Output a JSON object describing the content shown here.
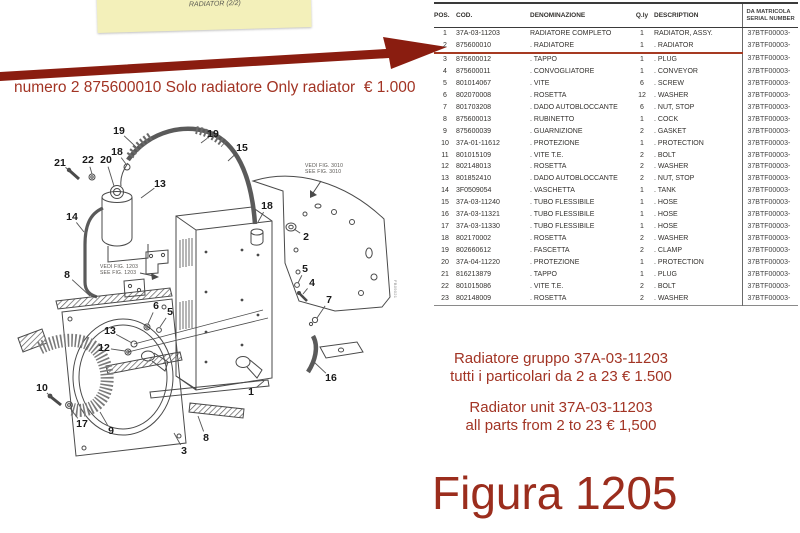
{
  "note": {
    "line1": "FIG. 1205      RADIATORE (2/2)",
    "line2": "RADIATOR (2/2)"
  },
  "annotation_top": "numero 2 875600010 Solo radiatore Only radiator  € 1.000",
  "table": {
    "headers": {
      "pos": "POS.",
      "cod": "COD.",
      "den": "DENOMINAZIONE",
      "qty": "Q.ly",
      "desc": "DESCRIPTION",
      "serial1": "DA MATRICOLA",
      "serial2": "SERIAL NUMBER"
    },
    "highlighted_pos": "2",
    "rows": [
      {
        "pos": "1",
        "cod": "37A-03-11203",
        "den": "RADIATORE COMPLETO",
        "qty": "1",
        "desc": "RADIATOR, ASSY.",
        "serial": "37BTF00003-"
      },
      {
        "pos": "2",
        "cod": "875600010",
        "den": ". RADIATORE",
        "qty": "1",
        "desc": ". RADIATOR",
        "serial": "37BTF00003-"
      },
      {
        "pos": "3",
        "cod": "875600012",
        "den": ". TAPPO",
        "qty": "1",
        "desc": ". PLUG",
        "serial": "37BTF00003-"
      },
      {
        "pos": "4",
        "cod": "875600011",
        "den": ". CONVOGLIATORE",
        "qty": "1",
        "desc": ". CONVEYOR",
        "serial": "37BTF00003-"
      },
      {
        "pos": "5",
        "cod": "801014067",
        "den": ". VITE",
        "qty": "6",
        "desc": ". SCREW",
        "serial": "37BTF00003-"
      },
      {
        "pos": "6",
        "cod": "802070008",
        "den": ". ROSETTA",
        "qty": "12",
        "desc": ". WASHER",
        "serial": "37BTF00003-"
      },
      {
        "pos": "7",
        "cod": "801703208",
        "den": ". DADO AUTOBLOCCANTE",
        "qty": "6",
        "desc": ". NUT, STOP",
        "serial": "37BTF00003-"
      },
      {
        "pos": "8",
        "cod": "875600013",
        "den": ". RUBINETTO",
        "qty": "1",
        "desc": ". COCK",
        "serial": "37BTF00003-"
      },
      {
        "pos": "9",
        "cod": "875600039",
        "den": ". GUARNIZIONE",
        "qty": "2",
        "desc": ". GASKET",
        "serial": "37BTF00003-"
      },
      {
        "pos": "10",
        "cod": "37A-01-11612",
        "den": ". PROTEZIONE",
        "qty": "1",
        "desc": ". PROTECTION",
        "serial": "37BTF00003-"
      },
      {
        "pos": "11",
        "cod": "801015109",
        "den": ". VITE T.E.",
        "qty": "2",
        "desc": ". BOLT",
        "serial": "37BTF00003-"
      },
      {
        "pos": "12",
        "cod": "802148013",
        "den": ". ROSETTA",
        "qty": "2",
        "desc": ". WASHER",
        "serial": "37BTF00003-"
      },
      {
        "pos": "13",
        "cod": "801852410",
        "den": ". DADO AUTOBLOCCANTE",
        "qty": "2",
        "desc": ". NUT, STOP",
        "serial": "37BTF00003-"
      },
      {
        "pos": "14",
        "cod": "3F0509054",
        "den": ". VASCHETTA",
        "qty": "1",
        "desc": ". TANK",
        "serial": "37BTF00003-"
      },
      {
        "pos": "15",
        "cod": "37A-03-11240",
        "den": ". TUBO FLESSIBILE",
        "qty": "1",
        "desc": ". HOSE",
        "serial": "37BTF00003-"
      },
      {
        "pos": "16",
        "cod": "37A-03-11321",
        "den": ". TUBO FLESSIBILE",
        "qty": "1",
        "desc": ". HOSE",
        "serial": "37BTF00003-"
      },
      {
        "pos": "17",
        "cod": "37A-03-11330",
        "den": ". TUBO FLESSIBILE",
        "qty": "1",
        "desc": ". HOSE",
        "serial": "37BTF00003-"
      },
      {
        "pos": "18",
        "cod": "802170002",
        "den": ". ROSETTA",
        "qty": "2",
        "desc": ". WASHER",
        "serial": "37BTF00003-"
      },
      {
        "pos": "19",
        "cod": "802660612",
        "den": ". FASCETTA",
        "qty": "2",
        "desc": ". CLAMP",
        "serial": "37BTF00003-"
      },
      {
        "pos": "20",
        "cod": "37A-04-11220",
        "den": ". PROTEZIONE",
        "qty": "1",
        "desc": ". PROTECTION",
        "serial": "37BTF00003-"
      },
      {
        "pos": "21",
        "cod": "816213879",
        "den": ". TAPPO",
        "qty": "1",
        "desc": ". PLUG",
        "serial": "37BTF00003-"
      },
      {
        "pos": "22",
        "cod": "801015086",
        "den": ". VITE T.E.",
        "qty": "2",
        "desc": ". BOLT",
        "serial": "37BTF00003-"
      },
      {
        "pos": "23",
        "cod": "802148009",
        "den": ". ROSETTA",
        "qty": "2",
        "desc": ". WASHER",
        "serial": "37BTF00003-"
      }
    ]
  },
  "diagram": {
    "fig_note_1203": [
      "VEDI FIG. 1203",
      "SEE FIG. 1203"
    ],
    "fig_note_3010": [
      "VEDI FIG. 3010",
      "SEE FIG. 3010"
    ],
    "side_label": "FB09021",
    "callouts": [
      {
        "n": "19",
        "x": 119,
        "y": 131,
        "lx": 136,
        "ly": 147
      },
      {
        "n": "18",
        "x": 117,
        "y": 152,
        "lx": 126,
        "ly": 164
      },
      {
        "n": "21",
        "x": 60,
        "y": 163,
        "lx": 70,
        "ly": 171
      },
      {
        "n": "22",
        "x": 88,
        "y": 160,
        "lx": 92,
        "ly": 174
      },
      {
        "n": "20",
        "x": 106,
        "y": 160,
        "lx": 114,
        "ly": 186
      },
      {
        "n": "13",
        "x": 160,
        "y": 184,
        "lx": 141,
        "ly": 198
      },
      {
        "n": "14",
        "x": 72,
        "y": 217,
        "lx": 84,
        "ly": 232
      },
      {
        "n": "8",
        "x": 67,
        "y": 275,
        "lx": 90,
        "ly": 296
      },
      {
        "n": "19",
        "x": 213,
        "y": 134,
        "lx": 201,
        "ly": 143
      },
      {
        "n": "15",
        "x": 242,
        "y": 148,
        "lx": 228,
        "ly": 161
      },
      {
        "n": "18",
        "x": 267,
        "y": 206,
        "lx": 258,
        "ly": 222
      },
      {
        "n": "2",
        "x": 306,
        "y": 237,
        "lx": 294,
        "ly": 229
      },
      {
        "n": "5",
        "x": 305,
        "y": 269,
        "lx": 298,
        "ly": 283
      },
      {
        "n": "4",
        "x": 312,
        "y": 283,
        "lx": 303,
        "ly": 294
      },
      {
        "n": "7",
        "x": 329,
        "y": 300,
        "lx": 317,
        "ly": 318
      },
      {
        "n": "6",
        "x": 156,
        "y": 306,
        "lx": 148,
        "ly": 324
      },
      {
        "n": "5",
        "x": 170,
        "y": 312,
        "lx": 160,
        "ly": 327
      },
      {
        "n": "13",
        "x": 110,
        "y": 331,
        "lx": 132,
        "ly": 343
      },
      {
        "n": "12",
        "x": 104,
        "y": 348,
        "lx": 125,
        "ly": 351
      },
      {
        "n": "10",
        "x": 42,
        "y": 388,
        "lx": 51,
        "ly": 397
      },
      {
        "n": "17",
        "x": 82,
        "y": 424,
        "lx": 70,
        "ly": 408
      },
      {
        "n": "9",
        "x": 111,
        "y": 431,
        "lx": 100,
        "ly": 412
      },
      {
        "n": "8",
        "x": 206,
        "y": 438,
        "lx": 198,
        "ly": 416
      },
      {
        "n": "3",
        "x": 184,
        "y": 451,
        "lx": 174,
        "ly": 433
      },
      {
        "n": "16",
        "x": 331,
        "y": 378,
        "lx": 314,
        "ly": 362
      },
      {
        "n": "1",
        "x": 251,
        "y": 392,
        "lx": 264,
        "ly": 381
      }
    ]
  },
  "bottom_notes": {
    "it1": "Radiatore gruppo 37A-03-11203",
    "it2": "tutti i particolari da 2 a 23 € 1.500",
    "en1": "Radiator unit 37A-03-11203",
    "en2": "all parts from 2 to 23 € 1,500"
  },
  "figure_title": "Figura 1205",
  "colors": {
    "accent_red": "#a23424",
    "arrow_red": "#8a1d10",
    "note_yellow": "#f3f0ba",
    "title_red": "#9b2d1d"
  }
}
